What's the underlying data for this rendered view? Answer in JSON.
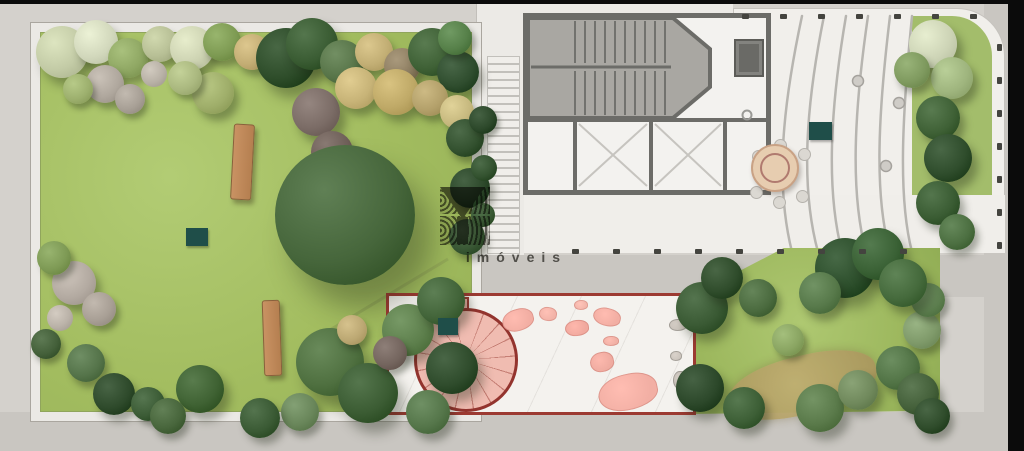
{
  "watermark": {
    "brand": "YBY",
    "tagline": "imóveis",
    "color": "#53514b"
  },
  "palette": {
    "sidewalk": "#d4d1cc",
    "road": "#c9c6c1",
    "lawn": "#a5c066",
    "terrace_floor": "#f1efeb",
    "building_wall": "#6c6c68",
    "stair_floor": "#a9a7a2",
    "interior": "#f3f2ef",
    "patio_outline": "#9c3a32",
    "patio_fill": "#f0bcb1",
    "stepping_stone": "#f2aea3",
    "marker_teal": "#1f4e49",
    "bench_wood": "#c08a5e",
    "fence_post": "#44443f",
    "table_top": "#e7cdb0"
  },
  "plan": {
    "markers": [
      {
        "id": "marker-garden",
        "x": 186,
        "y": 228,
        "w": 22,
        "h": 18
      },
      {
        "id": "marker-terrace",
        "x": 809,
        "y": 122,
        "w": 23,
        "h": 18
      },
      {
        "id": "marker-patio",
        "x": 438,
        "y": 318,
        "w": 20,
        "h": 17
      }
    ],
    "benches": [
      {
        "x": 232,
        "y": 124,
        "w": 21,
        "h": 76,
        "rot": 3
      },
      {
        "x": 263,
        "y": 300,
        "w": 18,
        "h": 76,
        "rot": -2
      }
    ],
    "fence_rows": [
      {
        "x": 742,
        "y": 14,
        "dx": 38,
        "dy": 0,
        "n": 7,
        "w": 7,
        "h": 5
      },
      {
        "x": 572,
        "y": 249,
        "dx": 41,
        "dy": 0,
        "n": 9,
        "w": 7,
        "h": 5
      },
      {
        "x": 997,
        "y": 44,
        "dx": 0,
        "dy": 33,
        "n": 7,
        "w": 5,
        "h": 7
      }
    ],
    "plants": [
      [
        62,
        52,
        26,
        "#c3cba6"
      ],
      [
        96,
        42,
        22,
        "#d2d8bc"
      ],
      [
        128,
        58,
        20,
        "#8fa763"
      ],
      [
        160,
        44,
        18,
        "#b7bf95"
      ],
      [
        192,
        48,
        22,
        "#cdd3b2"
      ],
      [
        222,
        42,
        19,
        "#7e9b53"
      ],
      [
        252,
        52,
        18,
        "#c3ad74"
      ],
      [
        286,
        58,
        30,
        "#2e4d2a"
      ],
      [
        312,
        44,
        26,
        "#3a5c33"
      ],
      [
        342,
        62,
        22,
        "#587549"
      ],
      [
        374,
        52,
        19,
        "#c2ae74"
      ],
      [
        402,
        66,
        18,
        "#8f7f62"
      ],
      [
        432,
        52,
        24,
        "#3f6136"
      ],
      [
        458,
        72,
        21,
        "#2f4d2e"
      ],
      [
        455,
        38,
        17,
        "#568049"
      ],
      [
        316,
        112,
        24,
        "#7b6c66"
      ],
      [
        332,
        152,
        21,
        "#6f6059"
      ],
      [
        356,
        88,
        21,
        "#c7b377"
      ],
      [
        396,
        92,
        23,
        "#bfa967"
      ],
      [
        430,
        98,
        18,
        "#b3a06a"
      ],
      [
        457,
        112,
        17,
        "#c7b97f"
      ],
      [
        105,
        84,
        19,
        "#b0a89e"
      ],
      [
        130,
        99,
        15,
        "#a8a096"
      ],
      [
        154,
        74,
        13,
        "#b8b1a6"
      ],
      [
        78,
        89,
        15,
        "#9db06e"
      ],
      [
        213,
        93,
        21,
        "#9fae6a"
      ],
      [
        185,
        78,
        17,
        "#aab87f"
      ],
      [
        74,
        283,
        22,
        "#b3aaa1"
      ],
      [
        99,
        309,
        17,
        "#a89f95"
      ],
      [
        60,
        318,
        13,
        "#bab2a8"
      ],
      [
        54,
        258,
        17,
        "#7e9a55"
      ],
      [
        46,
        344,
        15,
        "#44603a"
      ],
      [
        86,
        363,
        19,
        "#55744a"
      ],
      [
        114,
        394,
        21,
        "#2e4a2b"
      ],
      [
        148,
        404,
        17,
        "#3c5c36"
      ],
      [
        200,
        389,
        24,
        "#3f6233"
      ],
      [
        168,
        416,
        18,
        "#48663c"
      ],
      [
        465,
        138,
        19,
        "#33512f"
      ],
      [
        470,
        188,
        20,
        "#2c482a"
      ],
      [
        467,
        237,
        18,
        "#3a5835"
      ],
      [
        483,
        120,
        14,
        "#2c482a"
      ],
      [
        484,
        168,
        13,
        "#33522f"
      ],
      [
        483,
        215,
        12,
        "#3a5a34"
      ],
      [
        345,
        215,
        70,
        "#46663b"
      ],
      [
        330,
        362,
        34,
        "#4f7040"
      ],
      [
        368,
        393,
        30,
        "#3b5c33"
      ],
      [
        408,
        330,
        26,
        "#5d7f4c"
      ],
      [
        441,
        301,
        24,
        "#43653a"
      ],
      [
        452,
        368,
        26,
        "#2f4c2c"
      ],
      [
        428,
        412,
        22,
        "#55764a"
      ],
      [
        300,
        412,
        19,
        "#69865a"
      ],
      [
        390,
        353,
        17,
        "#74655e"
      ],
      [
        352,
        330,
        15,
        "#bca873"
      ],
      [
        260,
        418,
        20,
        "#3a5a34"
      ],
      [
        702,
        308,
        26,
        "#3a5a34"
      ],
      [
        722,
        278,
        21,
        "#2f4c2b"
      ],
      [
        758,
        298,
        19,
        "#4b6b3f"
      ],
      [
        700,
        388,
        24,
        "#2c482a"
      ],
      [
        744,
        408,
        21,
        "#3d5f36"
      ],
      [
        820,
        408,
        24,
        "#5a7a4a"
      ],
      [
        858,
        390,
        20,
        "#70895c"
      ],
      [
        898,
        368,
        22,
        "#527446"
      ],
      [
        922,
        330,
        19,
        "#7f9a6a"
      ],
      [
        928,
        300,
        17,
        "#5e8050"
      ],
      [
        845,
        268,
        30,
        "#2d4f2c"
      ],
      [
        878,
        254,
        26,
        "#3a6135"
      ],
      [
        903,
        283,
        24,
        "#456a3c"
      ],
      [
        820,
        293,
        21,
        "#57794a"
      ],
      [
        918,
        394,
        21,
        "#44603a"
      ],
      [
        932,
        416,
        18,
        "#2f4c2b"
      ],
      [
        788,
        340,
        16,
        "#8aa562"
      ],
      [
        933,
        44,
        24,
        "#cdd4b6"
      ],
      [
        952,
        78,
        21,
        "#9fb57e"
      ],
      [
        938,
        118,
        22,
        "#3f6136"
      ],
      [
        948,
        158,
        24,
        "#2f4d2c"
      ],
      [
        938,
        203,
        22,
        "#3a5c33"
      ],
      [
        957,
        232,
        18,
        "#4c6f41"
      ],
      [
        912,
        70,
        18,
        "#7f9a5f"
      ]
    ],
    "stepping_stones": [
      [
        518,
        320,
        16,
        11,
        -15,
        "#f2aea3"
      ],
      [
        548,
        314,
        9,
        7,
        10,
        "#f2b3a8"
      ],
      [
        577,
        328,
        12,
        8,
        -5,
        "#f0a99e"
      ],
      [
        607,
        317,
        14,
        9,
        15,
        "#f2aea3"
      ],
      [
        611,
        341,
        8,
        5,
        0,
        "#f0b0a5"
      ],
      [
        602,
        362,
        12,
        10,
        -10,
        "#efaba0"
      ],
      [
        628,
        392,
        30,
        18,
        -12,
        "#f2afa4"
      ],
      [
        581,
        305,
        7,
        5,
        0,
        "#f3b6ab"
      ],
      [
        678,
        325,
        9,
        6,
        0,
        "#c9c2ba"
      ],
      [
        680,
        380,
        7,
        9,
        0,
        "#c5beb6"
      ],
      [
        676,
        356,
        6,
        5,
        0,
        "#ccc5bd"
      ]
    ]
  }
}
